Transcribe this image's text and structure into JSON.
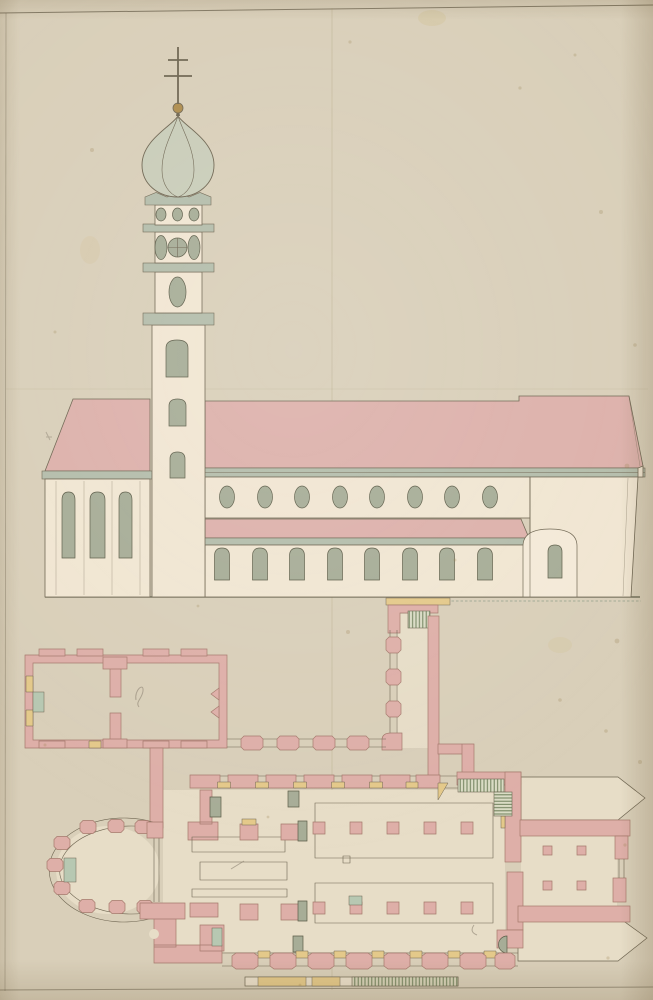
{
  "colors": {
    "paper": "#d9cfb9",
    "wall_cream": "#f1e6d2",
    "roof_pink": "#ddb1ab",
    "plan_pink": "#deafa8",
    "plan_stroke": "#a5796c",
    "window_gray": "#a7ad97",
    "cornice_gray": "#b4bdab",
    "dome_green": "#c9cdb9",
    "interior": "#e7ddc7",
    "accent_yellow": "#e4c98a",
    "accent_green": "#b7c8b2",
    "hatch_green": "#6e7f5a",
    "ink": "#6e6551",
    "ink_dark": "#5c5c48",
    "pencil": "#8b8170",
    "orb_gold": "#af8d4d",
    "stain_brown": "#9b8050"
  },
  "drawing": {
    "views": [
      {
        "name": "side elevation",
        "features": {
          "west_wing_arched_windows": 3,
          "clerestory_oval_windows": 8,
          "aisle_arched_windows": 8,
          "tower_shaft_windows": 3,
          "belfry_oval_windows": 6,
          "clock_faces": 1,
          "cross_bars": 2
        }
      },
      {
        "name": "ground plan",
        "features": {
          "west_apse_piers": 9,
          "nave_pier_rows": 2,
          "choir_square_piers": 4,
          "east_pointed_chapels": 2,
          "stair_flights": 3,
          "scale_bar_yellow_segments": 2
        }
      }
    ]
  }
}
